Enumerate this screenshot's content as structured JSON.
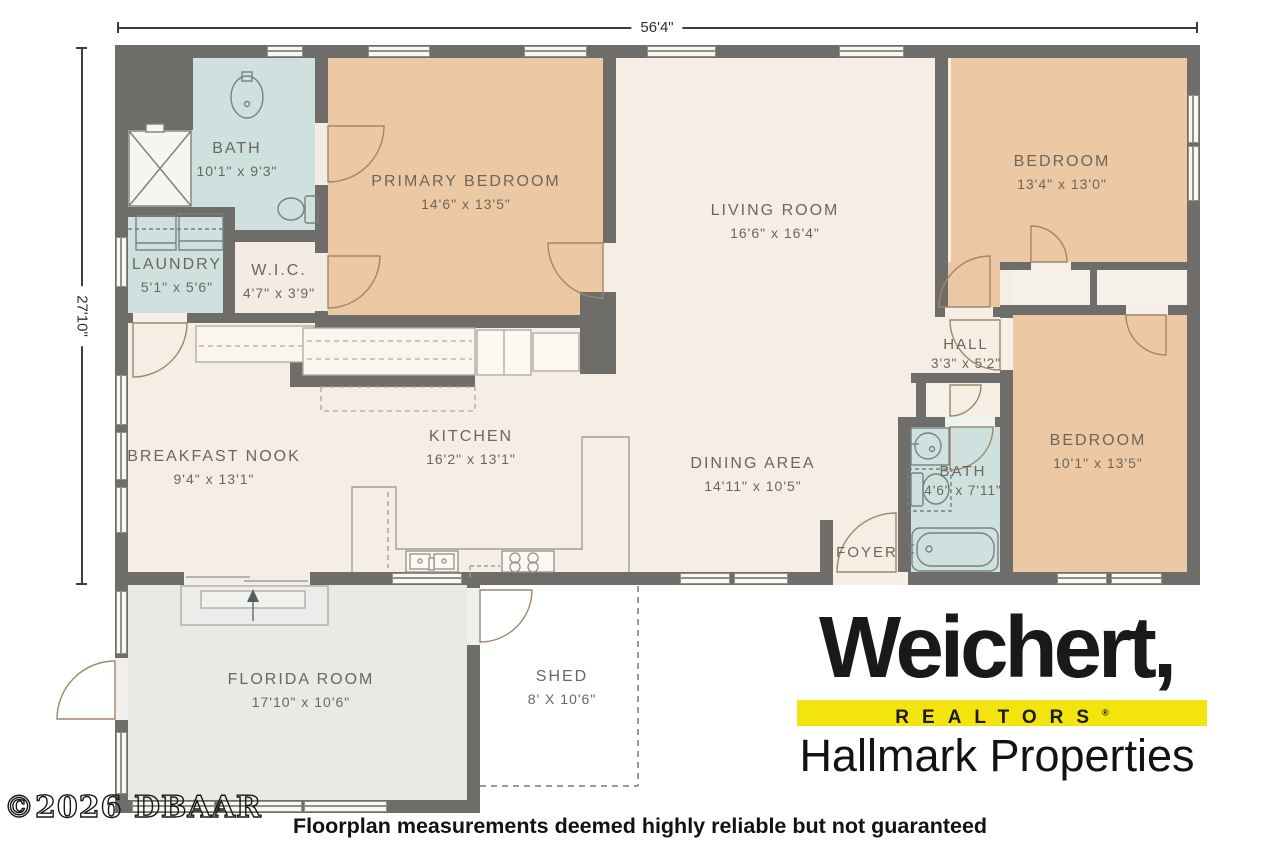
{
  "plan_dimensions": {
    "overall_width": "56'4\"",
    "overall_depth": "27'10\""
  },
  "rooms": {
    "bath1": {
      "name": "BATH",
      "dims": "10'1\" x 9'3\""
    },
    "primary": {
      "name": "PRIMARY BEDROOM",
      "dims": "14'6\" x 13'5\""
    },
    "living": {
      "name": "LIVING ROOM",
      "dims": "16'6\" x 16'4\""
    },
    "bedroom_tr": {
      "name": "BEDROOM",
      "dims": "13'4\" x 13'0\""
    },
    "laundry": {
      "name": "LAUNDRY",
      "dims": "5'1\" x 5'6\""
    },
    "wic": {
      "name": "W.I.C.",
      "dims": "4'7\" x 3'9\""
    },
    "nook": {
      "name": "BREAKFAST NOOK",
      "dims": "9'4\" x 13'1\""
    },
    "kitchen": {
      "name": "KITCHEN",
      "dims": "16'2\" x 13'1\""
    },
    "dining": {
      "name": "DINING AREA",
      "dims": "14'11\" x 10'5\""
    },
    "hall": {
      "name": "HALL",
      "dims": "3'3\" x 5'2\""
    },
    "bath2": {
      "name": "BATH",
      "dims": "4'6\" x 7'11\""
    },
    "bedroom_br": {
      "name": "BEDROOM",
      "dims": "10'1\" x 13'5\""
    },
    "foyer": {
      "name": "FOYER"
    },
    "florida": {
      "name": "FLORIDA ROOM",
      "dims": "17'10\" x 10'6\""
    },
    "shed": {
      "name": "SHED",
      "dims": "8' X 10'6\""
    }
  },
  "branding": {
    "brand": "Weichert,",
    "realtors": "REALTORS",
    "registered": "®",
    "office": "Hallmark Properties",
    "accent_yellow": "#f2e40c",
    "brand_black": "#191919"
  },
  "footer": {
    "disclaimer": "Floorplan measurements deemed highly reliable but not guaranteed",
    "copyright": "©2026 DBAAR"
  },
  "colors": {
    "wall": "#6e6d6a",
    "bedroom_tan": "#ecc9a4",
    "floor_cream": "#f6ede5",
    "bath_blue": "#cfe1df",
    "florida_gray": "#e9e9e6",
    "label_text": "#6e665b"
  }
}
